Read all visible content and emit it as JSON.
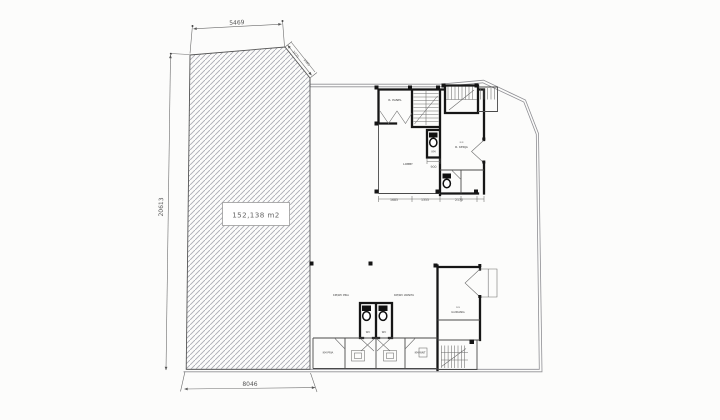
{
  "drawing_title": "Site / Ground Floor Plan",
  "area_label": "152,138  m2",
  "dimensions": {
    "top": "5469",
    "left": "20613",
    "bottom": "8046",
    "diag_a": "2275",
    "diag_b": "1985",
    "sub": [
      "1685",
      "1355",
      "2170",
      "900"
    ]
  },
  "rooms": {
    "panel": "R. PANEL",
    "office": "R. KERJA",
    "office_mark": "≈≈",
    "lobby": "LOBBY",
    "wc_small": "KM",
    "wc_left": "KM/WC PRIA",
    "wc_right": "KM/WC WANITA",
    "stall_left": "WC",
    "stall_right": "WC",
    "km_pria": "KM PRIA",
    "km_wanita": "KM WNT",
    "store_mark": "≈≈",
    "store": "GUDANG"
  },
  "colors": {
    "background": "#fcfcfb",
    "wall": "#161616",
    "thin_line": "#4a4a4a",
    "boundary": "#8f8f94",
    "hatch": "#aaacb4",
    "dimension": "#555555",
    "fixture": "#101010"
  }
}
